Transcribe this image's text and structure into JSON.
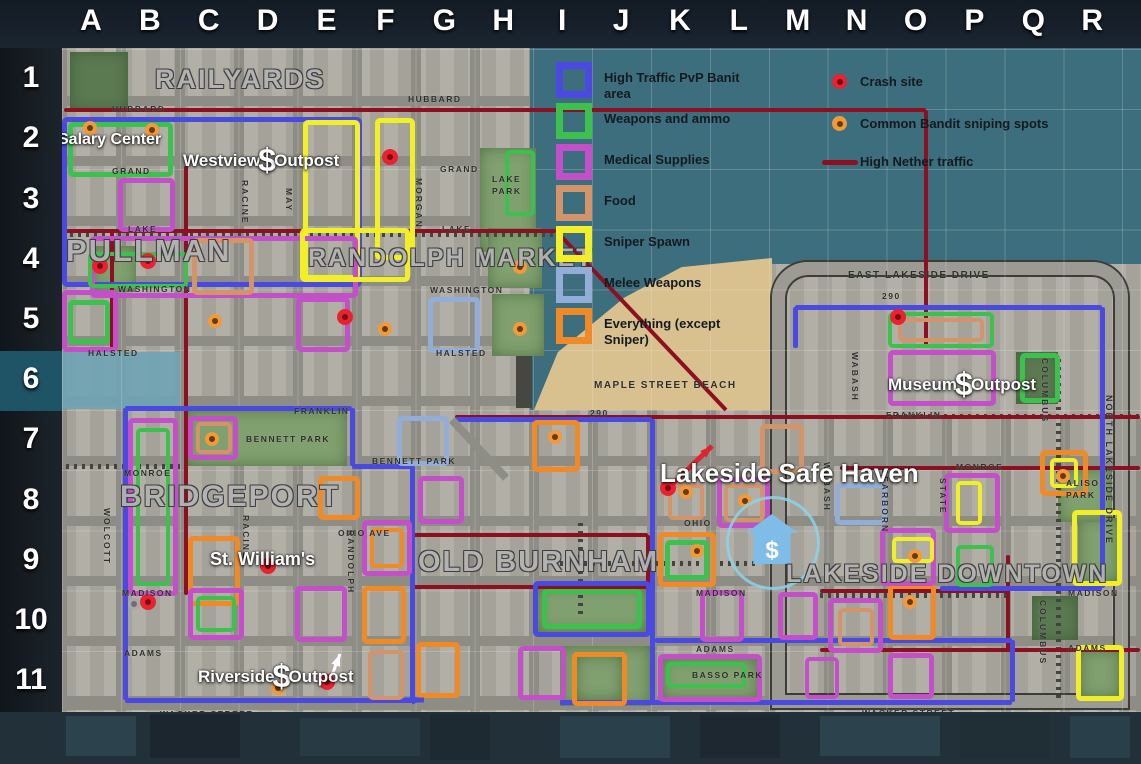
{
  "header": {
    "columns": [
      "A",
      "B",
      "C",
      "D",
      "E",
      "F",
      "G",
      "H",
      "I",
      "J",
      "K",
      "L",
      "M",
      "N",
      "O",
      "P",
      "Q",
      "R"
    ]
  },
  "sidebar": {
    "rows": [
      "1",
      "2",
      "3",
      "4",
      "5",
      "6",
      "7",
      "8",
      "9",
      "10",
      "11"
    ],
    "highlighted_row": "6"
  },
  "legend": {
    "left": [
      {
        "label": "High Traffic PvP Banit area",
        "color": "#4a4ae0"
      },
      {
        "label": "Weapons and ammo",
        "color": "#3cc04e"
      },
      {
        "label": "Medical Supplies",
        "color": "#c34fc9"
      },
      {
        "label": "Food",
        "color": "#d3946a"
      },
      {
        "label": "Sniper Spawn",
        "color": "#f1ef28"
      },
      {
        "label": "Melee Weapons",
        "color": "#92aed8"
      },
      {
        "label": "Everything (except Sniper)",
        "color": "#f08a26"
      }
    ],
    "right": [
      {
        "label": "Crash site",
        "icon": "crash"
      },
      {
        "label": "Common Bandit sniping spots",
        "icon": "bandit"
      },
      {
        "label": "High Nether traffic",
        "icon": "line"
      }
    ]
  },
  "map": {
    "colors": {
      "pvp": "#4a4ae0",
      "weapons": "#3cc04e",
      "medical": "#c34fc9",
      "food": "#d3946a",
      "sniper": "#f1ef28",
      "melee": "#92aed8",
      "everything": "#f08a26",
      "nether": "#8c1020",
      "crash": "#e8232f",
      "crash_core": "#7a0d14",
      "bandit": "#f09a3c",
      "bandit_core": "#6b3a10"
    },
    "base_colors": {
      "water": "#3d6e7d",
      "sand": "#d9c18f",
      "road": "#8d8d85",
      "block": "#aeaba2"
    },
    "districts": [
      {
        "t": "RAILYARDS",
        "x": 155,
        "y": 64,
        "fs": 27
      },
      {
        "t": "PULLMAN",
        "x": 66,
        "y": 233,
        "fs": 31
      },
      {
        "t": "RANDOLPH MARKET",
        "x": 308,
        "y": 244,
        "fs": 25
      },
      {
        "t": "BRIDGEPORT",
        "x": 120,
        "y": 480,
        "fs": 30
      },
      {
        "t": "OLD BURNHAM",
        "x": 418,
        "y": 546,
        "fs": 29
      },
      {
        "t": "LAKESIDE DOWNTOWN",
        "x": 786,
        "y": 560,
        "fs": 25
      }
    ],
    "places": [
      {
        "pre": "Salary Center",
        "x": 58,
        "y": 131,
        "fs": 16
      },
      {
        "pre": "Westview",
        "dollar": "$",
        "post": "Outpost",
        "x": 183,
        "y": 146,
        "fs": 17
      },
      {
        "pre": "St. William's",
        "x": 210,
        "y": 549,
        "fs": 18
      },
      {
        "pre": "Riverside",
        "dollar": "$",
        "post": "Outpost",
        "x": 198,
        "y": 662,
        "fs": 17
      },
      {
        "pre": "Museum",
        "dollar": "$",
        "post": "Outpost",
        "x": 888,
        "y": 370,
        "fs": 17
      },
      {
        "pre": "Lakeside Safe Haven",
        "x": 660,
        "y": 458,
        "fs": 26
      }
    ],
    "safe_haven": {
      "symbol": "$"
    },
    "streets": [
      {
        "t": "HUBBARD",
        "x": 112,
        "y": 104
      },
      {
        "t": "HUBBARD",
        "x": 408,
        "y": 94
      },
      {
        "t": "GRAND",
        "x": 112,
        "y": 166
      },
      {
        "t": "GRAND",
        "x": 440,
        "y": 164
      },
      {
        "t": "LAKE",
        "x": 128,
        "y": 224
      },
      {
        "t": "LAKE",
        "x": 442,
        "y": 224
      },
      {
        "t": "WASHINGTON",
        "x": 118,
        "y": 284
      },
      {
        "t": "WASHINGTON",
        "x": 430,
        "y": 285
      },
      {
        "t": "HALSTED",
        "x": 88,
        "y": 348
      },
      {
        "t": "HALSTED",
        "x": 436,
        "y": 348
      },
      {
        "t": "FRANKLIN",
        "x": 294,
        "y": 406
      },
      {
        "t": "FRANKLIN",
        "x": 886,
        "y": 410
      },
      {
        "t": "290",
        "x": 882,
        "y": 291
      },
      {
        "t": "290",
        "x": 590,
        "y": 408
      },
      {
        "t": "EAST LAKESIDE DRIVE",
        "x": 848,
        "y": 270,
        "fs": 10
      },
      {
        "t": "MAPLE STREET BEACH",
        "x": 594,
        "y": 380,
        "fs": 10
      },
      {
        "t": "BENNETT PARK",
        "x": 372,
        "y": 456
      },
      {
        "t": "MONROE",
        "x": 124,
        "y": 468
      },
      {
        "t": "MONROE",
        "x": 956,
        "y": 462
      },
      {
        "t": "OHIO AVE",
        "x": 338,
        "y": 528
      },
      {
        "t": "OHIO",
        "x": 684,
        "y": 518
      },
      {
        "t": "MADISON",
        "x": 122,
        "y": 588
      },
      {
        "t": "MADISON",
        "x": 696,
        "y": 588
      },
      {
        "t": "MADISON",
        "x": 1068,
        "y": 588
      },
      {
        "t": "ADAMS",
        "x": 124,
        "y": 648
      },
      {
        "t": "ADAMS",
        "x": 696,
        "y": 644
      },
      {
        "t": "ADAMS",
        "x": 1068,
        "y": 643
      },
      {
        "t": "WACKER STREET",
        "x": 160,
        "y": 709
      },
      {
        "t": "WACKER STREET",
        "x": 592,
        "y": 710
      },
      {
        "t": "WACKER STREET",
        "x": 862,
        "y": 708
      },
      {
        "t": "MAY",
        "x": 284,
        "y": 188,
        "v": 1
      },
      {
        "t": "RACINE",
        "x": 240,
        "y": 180,
        "v": 1
      },
      {
        "t": "MORGAN",
        "x": 414,
        "y": 178,
        "v": 1
      },
      {
        "t": "WOLCOTT",
        "x": 102,
        "y": 508,
        "v": 1
      },
      {
        "t": "RACINE",
        "x": 241,
        "y": 515,
        "v": 1
      },
      {
        "t": "RANDOLPH",
        "x": 346,
        "y": 530,
        "v": 1
      },
      {
        "t": "WABASH",
        "x": 850,
        "y": 352,
        "v": 1
      },
      {
        "t": "WABASH",
        "x": 822,
        "y": 462,
        "v": 1
      },
      {
        "t": "DEARBORN",
        "x": 880,
        "y": 468,
        "v": 1
      },
      {
        "t": "STATE",
        "x": 938,
        "y": 478,
        "v": 1
      },
      {
        "t": "COLUMBUS",
        "x": 1040,
        "y": 358,
        "v": 1
      },
      {
        "t": "COLUMBUS",
        "x": 1038,
        "y": 600,
        "v": 1
      },
      {
        "t": "NORTH LAKESIDE DRIVE",
        "x": 1104,
        "y": 395,
        "v": 1,
        "fs": 9
      }
    ],
    "park_labels": [
      {
        "t": "LAKE",
        "x": 492,
        "y": 174
      },
      {
        "t": "PARK",
        "x": 492,
        "y": 186
      },
      {
        "t": "BENNETT PARK",
        "x": 246,
        "y": 434
      },
      {
        "t": "BASSO PARK",
        "x": 692,
        "y": 670
      },
      {
        "t": "ALISO",
        "x": 1066,
        "y": 478
      },
      {
        "t": "PARK",
        "x": 1066,
        "y": 490
      }
    ],
    "parks": [
      [
        70,
        52,
        58,
        58,
        1
      ],
      [
        480,
        148,
        56,
        104,
        0
      ],
      [
        488,
        228,
        54,
        60,
        0
      ],
      [
        492,
        294,
        52,
        62,
        0
      ],
      [
        92,
        246,
        44,
        46,
        0
      ],
      [
        185,
        410,
        162,
        56,
        0
      ],
      [
        538,
        586,
        108,
        46,
        0
      ],
      [
        560,
        646,
        90,
        60,
        0
      ],
      [
        576,
        656,
        46,
        44,
        0
      ],
      [
        662,
        658,
        96,
        42,
        0
      ],
      [
        1078,
        518,
        42,
        64,
        0
      ],
      [
        1058,
        468,
        54,
        54,
        0
      ],
      [
        1080,
        650,
        40,
        48,
        0
      ],
      [
        1016,
        352,
        42,
        52,
        1
      ],
      [
        1032,
        596,
        46,
        44,
        1
      ]
    ],
    "rails": [
      [
        58,
        466,
        180,
        466
      ],
      [
        560,
        563,
        756,
        563
      ],
      [
        580,
        522,
        580,
        614
      ],
      [
        888,
        416,
        1140,
        416
      ],
      [
        820,
        595,
        1006,
        595
      ],
      [
        1058,
        354,
        1058,
        698
      ],
      [
        62,
        234,
        554,
        234
      ]
    ],
    "nether_segments": [
      [
        64,
        110,
        926,
        110
      ],
      [
        926,
        110,
        926,
        348
      ],
      [
        186,
        166,
        186,
        595
      ],
      [
        112,
        232,
        112,
        352
      ],
      [
        62,
        231,
        556,
        231
      ],
      [
        412,
        535,
        648,
        535
      ],
      [
        412,
        587,
        648,
        587
      ],
      [
        412,
        535,
        412,
        587
      ],
      [
        648,
        535,
        648,
        587
      ],
      [
        455,
        417,
        1140,
        417
      ],
      [
        840,
        468,
        1140,
        468
      ],
      [
        820,
        591,
        1008,
        591
      ],
      [
        1008,
        555,
        1008,
        652
      ],
      [
        820,
        650,
        1140,
        650
      ]
    ],
    "pvp_segments": [
      [
        125,
        408,
        352,
        408
      ],
      [
        352,
        408,
        352,
        466
      ],
      [
        352,
        466,
        412,
        466
      ],
      [
        412,
        466,
        412,
        700
      ],
      [
        125,
        408,
        125,
        700
      ],
      [
        125,
        700,
        414,
        700
      ],
      [
        455,
        419,
        652,
        419
      ],
      [
        652,
        419,
        652,
        702
      ],
      [
        560,
        702,
        1012,
        702
      ],
      [
        1012,
        640,
        1012,
        702
      ],
      [
        655,
        640,
        1012,
        640
      ],
      [
        795,
        307,
        1102,
        307
      ],
      [
        795,
        307,
        795,
        348
      ],
      [
        1102,
        307,
        1102,
        588
      ],
      [
        940,
        588,
        1102,
        588
      ]
    ],
    "diagonals": [
      {
        "x1": 558,
        "y1": 233,
        "x2": 726,
        "y2": 410,
        "c": "#8c1020",
        "w": 4
      },
      {
        "x1": 452,
        "y1": 420,
        "x2": 506,
        "y2": 478,
        "c": "#8e8e86",
        "w": 8
      },
      {
        "x1": 664,
        "y1": 492,
        "x2": 712,
        "y2": 446,
        "c": "#df2330",
        "w": 5,
        "arrow": 1
      },
      {
        "x1": 404,
        "y1": 700,
        "x2": 424,
        "y2": 700,
        "c": "#4a4ae0",
        "w": 5,
        "arrow": 1
      },
      {
        "x1": 328,
        "y1": 686,
        "x2": 340,
        "y2": 654,
        "c": "#ffffff",
        "w": 3,
        "arrow": 1
      }
    ],
    "zones": [
      [
        62,
        117,
        300,
        170,
        "pvp"
      ],
      [
        68,
        122,
        105,
        55,
        "weapons"
      ],
      [
        303,
        120,
        57,
        160,
        "sniper"
      ],
      [
        375,
        118,
        40,
        142,
        "sniper"
      ],
      [
        118,
        178,
        57,
        54,
        "medical"
      ],
      [
        90,
        236,
        268,
        62,
        "medical"
      ],
      [
        88,
        252,
        100,
        36,
        "weapons"
      ],
      [
        192,
        238,
        62,
        57,
        "food"
      ],
      [
        300,
        228,
        110,
        54,
        "sniper"
      ],
      [
        62,
        290,
        56,
        62,
        "medical"
      ],
      [
        68,
        300,
        42,
        44,
        "weapons"
      ],
      [
        296,
        297,
        54,
        55,
        "medical"
      ],
      [
        428,
        297,
        52,
        56,
        "melee"
      ],
      [
        505,
        150,
        30,
        66,
        "weapons"
      ],
      [
        128,
        418,
        50,
        178,
        "medical"
      ],
      [
        136,
        428,
        34,
        158,
        "weapons"
      ],
      [
        188,
        416,
        50,
        44,
        "medical"
      ],
      [
        196,
        422,
        36,
        32,
        "food"
      ],
      [
        397,
        416,
        52,
        50,
        "melee"
      ],
      [
        532,
        420,
        48,
        52,
        "everything"
      ],
      [
        188,
        536,
        52,
        70,
        "everything"
      ],
      [
        318,
        476,
        42,
        44,
        "everything"
      ],
      [
        418,
        476,
        46,
        48,
        "medical"
      ],
      [
        362,
        520,
        50,
        56,
        "medical"
      ],
      [
        370,
        528,
        34,
        40,
        "everything"
      ],
      [
        188,
        588,
        56,
        52,
        "medical"
      ],
      [
        196,
        596,
        40,
        36,
        "weapons"
      ],
      [
        295,
        586,
        52,
        56,
        "medical"
      ],
      [
        362,
        586,
        44,
        58,
        "everything"
      ],
      [
        368,
        650,
        36,
        50,
        "food"
      ],
      [
        416,
        642,
        44,
        56,
        "everything"
      ],
      [
        533,
        581,
        118,
        56,
        "pvp"
      ],
      [
        542,
        589,
        100,
        40,
        "weapons"
      ],
      [
        518,
        646,
        48,
        54,
        "medical"
      ],
      [
        572,
        652,
        55,
        54,
        "everything"
      ],
      [
        658,
        654,
        104,
        48,
        "medical"
      ],
      [
        666,
        662,
        80,
        26,
        "weapons"
      ],
      [
        805,
        657,
        34,
        42,
        "medical"
      ],
      [
        888,
        653,
        46,
        46,
        "medical"
      ],
      [
        1076,
        645,
        48,
        56,
        "sniper"
      ],
      [
        828,
        598,
        55,
        55,
        "medical"
      ],
      [
        838,
        608,
        36,
        38,
        "food"
      ],
      [
        888,
        584,
        48,
        56,
        "everything"
      ],
      [
        700,
        590,
        44,
        52,
        "medical"
      ],
      [
        778,
        592,
        40,
        48,
        "medical"
      ],
      [
        658,
        532,
        58,
        55,
        "everything"
      ],
      [
        665,
        540,
        44,
        40,
        "weapons"
      ],
      [
        717,
        477,
        53,
        51,
        "medical"
      ],
      [
        724,
        484,
        40,
        38,
        "food"
      ],
      [
        668,
        484,
        36,
        36,
        "food"
      ],
      [
        835,
        483,
        52,
        42,
        "melee"
      ],
      [
        880,
        528,
        56,
        58,
        "medical"
      ],
      [
        892,
        537,
        42,
        26,
        "sniper"
      ],
      [
        944,
        473,
        56,
        60,
        "medical"
      ],
      [
        956,
        481,
        26,
        44,
        "sniper"
      ],
      [
        956,
        545,
        38,
        42,
        "weapons"
      ],
      [
        760,
        424,
        44,
        50,
        "food"
      ],
      [
        1040,
        450,
        48,
        46,
        "everything"
      ],
      [
        1050,
        458,
        28,
        30,
        "sniper"
      ],
      [
        888,
        312,
        106,
        36,
        "weapons"
      ],
      [
        898,
        318,
        86,
        24,
        "food"
      ],
      [
        888,
        350,
        108,
        56,
        "medical"
      ],
      [
        1020,
        353,
        40,
        50,
        "weapons"
      ],
      [
        1072,
        510,
        50,
        76,
        "sniper"
      ]
    ],
    "crash_sites": [
      [
        390,
        157
      ],
      [
        148,
        261
      ],
      [
        100,
        266
      ],
      [
        345,
        317
      ],
      [
        268,
        566
      ],
      [
        148,
        602
      ],
      [
        327,
        682
      ],
      [
        898,
        317
      ],
      [
        668,
        488
      ]
    ],
    "sniper_spots": [
      [
        90,
        128
      ],
      [
        152,
        130
      ],
      [
        215,
        321
      ],
      [
        385,
        329
      ],
      [
        520,
        267
      ],
      [
        520,
        329
      ],
      [
        212,
        439
      ],
      [
        555,
        437
      ],
      [
        278,
        688
      ],
      [
        686,
        492
      ],
      [
        697,
        551
      ],
      [
        745,
        501
      ],
      [
        915,
        556
      ],
      [
        1063,
        476
      ],
      [
        910,
        602
      ]
    ],
    "misc_dots": [
      [
        134,
        604
      ]
    ]
  },
  "footer_blocks": [
    [
      66,
      716,
      70,
      40,
      "#2c434e"
    ],
    [
      150,
      714,
      90,
      44,
      "#1c262e"
    ],
    [
      300,
      718,
      120,
      38,
      "#283a44"
    ],
    [
      430,
      714,
      60,
      46,
      "#1e2a32"
    ],
    [
      560,
      716,
      110,
      42,
      "#2a404b"
    ],
    [
      700,
      714,
      80,
      44,
      "#1d2830"
    ],
    [
      820,
      716,
      120,
      40,
      "#2c434e"
    ],
    [
      960,
      714,
      90,
      44,
      "#202e36"
    ],
    [
      1070,
      716,
      60,
      42,
      "#293f49"
    ]
  ]
}
